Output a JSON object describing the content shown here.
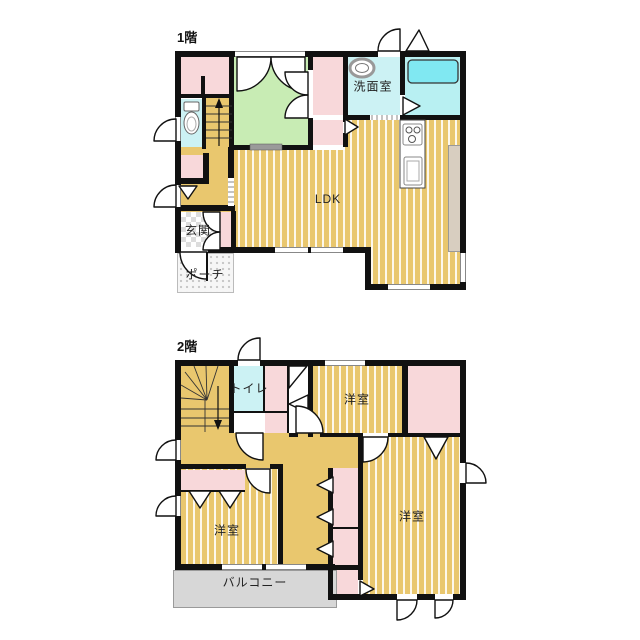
{
  "floor1": {
    "title": "1階",
    "rooms": {
      "washroom": "洗面室",
      "ldk": "LDK",
      "entrance": "玄関",
      "porch": "ポーチ"
    }
  },
  "floor2": {
    "title": "2階",
    "rooms": {
      "toilet": "トイレ",
      "bedroom_top": "洋室",
      "bedroom_left": "洋室",
      "bedroom_right": "洋室",
      "balcony": "バルコニー"
    }
  },
  "colors": {
    "wall": "#111111",
    "wood_floor": "#e9c76e",
    "pink_room": "#f8d8da",
    "green_room": "#c8ecb4",
    "cyan_room": "#ccf2f4",
    "bath_floor": "#b8f0f2",
    "bathtub": "#80e8f2",
    "balcony": "#d7d7d7",
    "counter": "#d8cec0",
    "window_line": "#888888"
  }
}
